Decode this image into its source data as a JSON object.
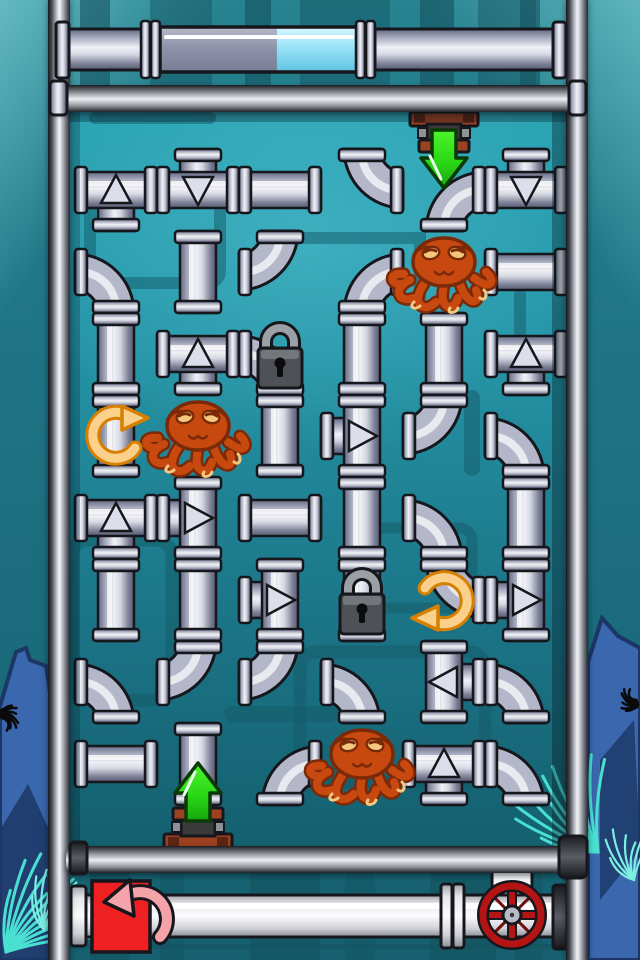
{
  "meta": {
    "app": "underwater-pipe-puzzle",
    "width": 640,
    "height": 960
  },
  "palette": {
    "outside_teal": "#1f7585",
    "board_top": "#2ba4b4",
    "board_bottom": "#14606f",
    "pattern_dark": "#135a68",
    "slat_dark": "#14525f",
    "pipe_mid": "#b4b7c9",
    "pipe_light": "#f0f1f6",
    "pipe_dark": "#62677f",
    "outline": "#16171c",
    "lock_body": "#4e5256",
    "lock_bevel": "#71777b",
    "lock_shackle": "#9aa0a6",
    "octopus_fill": "#c8490f",
    "octopus_outline": "#7a2a08",
    "octopus_accent": "#f6c77e",
    "rotate_fill": "#fbd08a",
    "rotate_edge": "#d67f00",
    "green_light": "#4ef32c",
    "green_dark": "#17a50d",
    "green_outline": "#0c3a06",
    "brown_flange": "#9c4121",
    "fitting_dark": "#3a3a3a",
    "bolt_gray": "#8e9296",
    "timer_gray_fill": "#8e92aa",
    "timer_blue_fill": "#9fe5f8",
    "white_pipe": "#fbfbfd",
    "button_red": "#ee2022",
    "undo_pink": "#f4a3ab",
    "wheel_red": "#b41414",
    "hub_gray": "#b8bac6",
    "decor_blue": "#3a67ad",
    "decor_navy": "#1c3765",
    "decor_cyan": "#49e0d2",
    "urchin_black": "#0a0a0a"
  },
  "board": {
    "cols": 6,
    "rows": 8,
    "cell": 82,
    "origin_x": 75,
    "origin_y": 149,
    "legend": {
      "H": "straight-horizontal",
      "V": "straight-vertical",
      "Etl": "elbow-top-left",
      "Etr": "elbow-top-right",
      "Ebl": "elbow-bottom-left",
      "Ebr": "elbow-bottom-right",
      "Tu": "tee-branch-up-arrow-down",
      "Td": "tee-branch-down-arrow-up",
      "Tl": "tee-branch-left-arrow-right",
      "Tr": "tee-branch-right-arrow-left",
      ".": "empty"
    },
    "grid": [
      [
        "Td",
        "Tu",
        "H",
        "Etr",
        "Ebr",
        "Tu"
      ],
      [
        "Ebl",
        "V",
        "Etl",
        "Ebr",
        ".",
        "H"
      ],
      [
        "V",
        "Td",
        "Ebl",
        "V",
        "V",
        "Td"
      ],
      [
        "V",
        ".",
        "V",
        "Tl",
        "Etl",
        "Ebl"
      ],
      [
        "Td",
        "Tl",
        "H",
        "V",
        "Ebl",
        "V"
      ],
      [
        "V",
        "V",
        "Tl",
        "V",
        "Etr",
        "Tl"
      ],
      [
        "Ebl",
        "Etl",
        "Etl",
        "Ebl",
        "Tr",
        "Ebl"
      ],
      [
        "H",
        "V",
        "Ebr",
        ".",
        "Td",
        "Ebl"
      ]
    ],
    "octopuses": [
      {
        "col": 4,
        "row": 1
      },
      {
        "col": 1,
        "row": 3
      },
      {
        "col": 3,
        "row": 7
      }
    ],
    "locks": [
      {
        "col": 2,
        "row": 2
      },
      {
        "col": 3,
        "row": 5
      }
    ],
    "rotate_hints": [
      {
        "col": 0,
        "row": 3,
        "dir": "cw"
      },
      {
        "col": 4,
        "row": 5,
        "dir": "ccw"
      }
    ],
    "inlet": {
      "col": 4,
      "edge": "top",
      "arrow": "down"
    },
    "outlet": {
      "col": 1,
      "edge": "bottom",
      "arrow": "up"
    }
  },
  "timer": {
    "fill_fraction_remaining": 0.41,
    "fill_side": "right",
    "tube_x1": 160,
    "tube_x2": 358,
    "y_top": 20,
    "y_bottom": 78
  },
  "controls": {
    "undo_button": {
      "kind": "red-square-with-pink-ccw-arrow",
      "x": 92,
      "y": 881,
      "w": 58,
      "h": 71
    },
    "valve_wheel": {
      "kind": "red-hand-wheel",
      "cx": 512,
      "cy": 915,
      "r": 29
    }
  }
}
